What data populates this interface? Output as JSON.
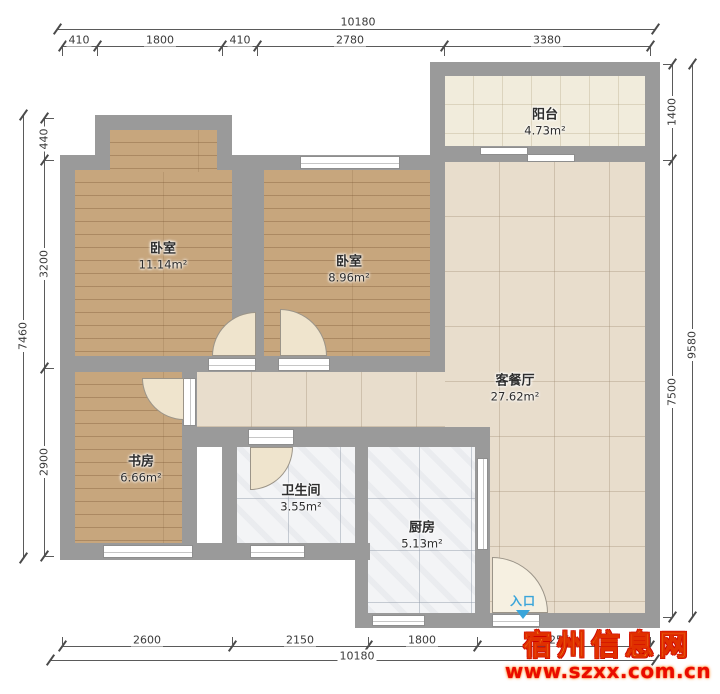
{
  "plan": {
    "rooms": [
      {
        "id": "bedroom-1",
        "name": "卧室",
        "area": "11.14m²"
      },
      {
        "id": "bedroom-2",
        "name": "卧室",
        "area": "8.96m²"
      },
      {
        "id": "balcony",
        "name": "阳台",
        "area": "4.73m²"
      },
      {
        "id": "living-dining",
        "name": "客餐厅",
        "area": "27.62m²"
      },
      {
        "id": "study",
        "name": "书房",
        "area": "6.66m²"
      },
      {
        "id": "bathroom",
        "name": "卫生间",
        "area": "3.55m²"
      },
      {
        "id": "kitchen",
        "name": "厨房",
        "area": "5.13m²"
      }
    ],
    "entrance_label": "入口",
    "colors": {
      "wall": "#9a9a9a",
      "wood_floor": "#c7a67d",
      "living_tile": "#e8ddcc",
      "balcony_tile": "#f1ecdc",
      "wet_room_tile": "#f3f4f6",
      "entrance_blue": "#3aa5da",
      "watermark_yellow": "#ffdf33",
      "watermark_red": "#ea0b00"
    }
  },
  "dimensions": {
    "top": {
      "total": "10180",
      "segments": [
        "410",
        "1800",
        "410",
        "2780",
        "3380"
      ]
    },
    "bottom": {
      "total": "10180",
      "segments": [
        "2600",
        "2150",
        "1800",
        "2550"
      ]
    },
    "left": {
      "total": "7460",
      "segments": [
        "440",
        "3200",
        "2900"
      ]
    },
    "right": {
      "total": "9580",
      "segments": [
        "1400",
        "7500"
      ]
    }
  },
  "watermark": {
    "site_name": "宿州信息网",
    "site_url": "www.szxx.com.cn"
  }
}
